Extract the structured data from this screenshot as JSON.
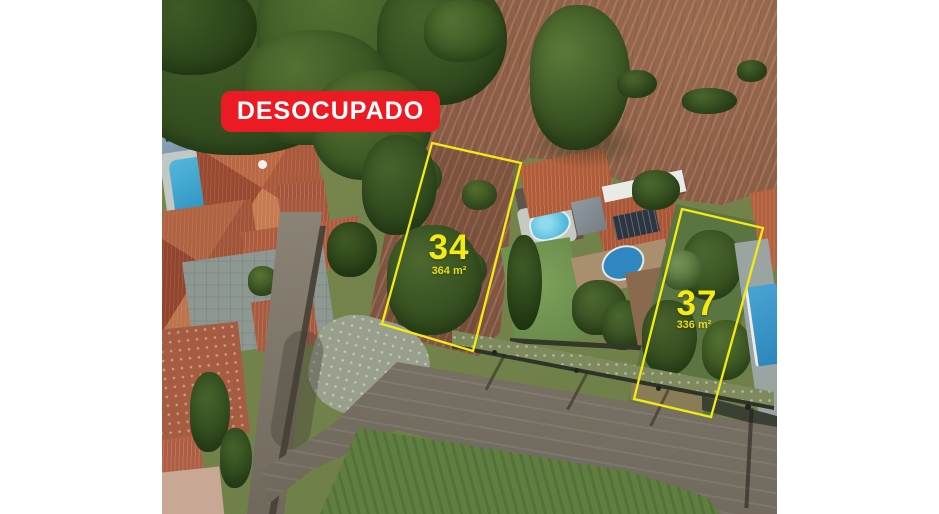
{
  "badge": {
    "label": "DESOCUPADO"
  },
  "lots": [
    {
      "number": "34",
      "area": "364 m²",
      "polygon": "270,143 359,163 311,351 220,324"
    },
    {
      "number": "37",
      "area": "336 m²",
      "polygon": "520,209 601,228 549,417 472,399"
    }
  ],
  "colors": {
    "badge_bg": "#ec1b23",
    "badge_text": "#ffffff",
    "lot_outline": "#f3eb12",
    "lot_label": "#f3eb12"
  }
}
